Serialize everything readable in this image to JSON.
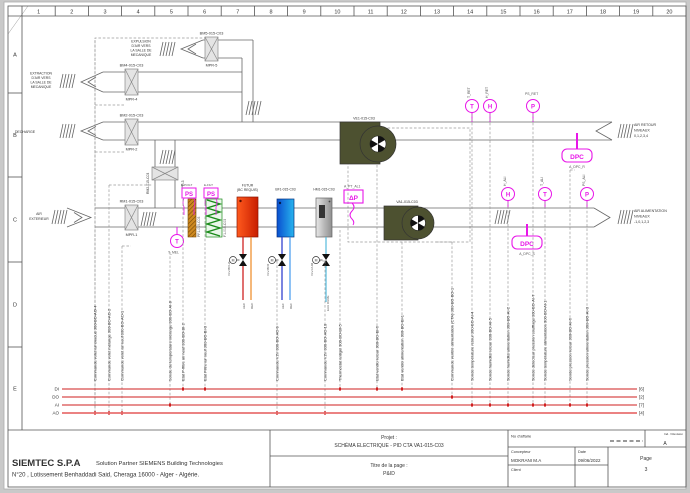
{
  "sheet": {
    "columns": [
      "1",
      "2",
      "3",
      "4",
      "5",
      "6",
      "7",
      "8",
      "9",
      "10",
      "11",
      "12",
      "13",
      "14",
      "15",
      "16",
      "17",
      "18",
      "19",
      "20"
    ],
    "rows": [
      "A",
      "B",
      "C",
      "D",
      "E"
    ]
  },
  "labels": {
    "expulsion": [
      "EXPULSION",
      "D'AIR VERS",
      "LA SALLE DE",
      "MECANIQUE"
    ],
    "extraction": [
      "EXTRACTION",
      "D'AIR VERS",
      "LA SALLE DE",
      "MECANIQUE"
    ],
    "decharge": "DECHARGE",
    "air_exterieur": [
      "AIR",
      "EXTERIEUR"
    ],
    "air_retour": [
      "AIR RETOUR",
      "NIVEAUX",
      "0,1,2,3,4"
    ],
    "air_alimentation": [
      "AIR ALIMENTATION",
      "NIVEAUX",
      "-1,0,1,2,3"
    ]
  },
  "dampers": [
    {
      "tag": "BM5-015-C03",
      "motor": "MPR-5"
    },
    {
      "tag": "BM4-015-C03",
      "motor": "MPR-4"
    },
    {
      "tag": "BM2-015-C03",
      "motor": "MPR-2"
    },
    {
      "tag": "RM2-015-C03",
      "motor": "MPR-3"
    },
    {
      "tag": "RM1-015-C03",
      "motor": "MPR-1"
    }
  ],
  "filters": {
    "ps": "PS",
    "prefilter_switch": "E-P.FILT",
    "filter_switch": "E-FILT",
    "prefilter_tag": "PF1-015-C03",
    "filter_tag": "F1-015-C03"
  },
  "coils": {
    "hot_line1": "FUTUR",
    "hot_line2": "(BC REQUIS)",
    "cold": "BF1-015-C03",
    "humidifier": "HM1-015-C03"
  },
  "fans": {
    "extract": "VE1-015-C03",
    "supply": "VA1-015-C03"
  },
  "sensors": {
    "letters": {
      "t": "T",
      "h": "H",
      "p": "P",
      "m": "M"
    },
    "dp": "ΔP",
    "dp_tag": "A_PT_AL1",
    "t_mel": "T_MEL",
    "t_ret": "T_RET",
    "h_ret": "H_RET",
    "ps_ret": "PS_RET",
    "h_ali": "H_ALI",
    "t_ali": "T_ALI",
    "ps_ali": "PS_ALI",
    "dpc": "DPC",
    "dpc_r": "A_DPC_R",
    "dpc_s": "A_DPC_S"
  },
  "valves": {
    "hot": "VLV-BCHA",
    "cold": "VLV-BFR",
    "hum": "VLV-HUM",
    "pipes": {
      "aec": "AEC",
      "rec": "REC",
      "aef": "AEF",
      "ref": "REF",
      "eau": "EAU DURE"
    }
  },
  "io_points": [
    "Commande volet air évacué 300-BO-AO-4",
    "Commande volet mélange 300-BO-AO-2",
    "Commande volet air neuf 300-BO-AO-1",
    "Sonde de température mélange 300-BO-AI-8",
    "Etat P-filtre air neuf 300-BO-BI-2",
    "Etat Filtre air neuf 300-BO-BI-3",
    "Commande V2V 300-BO-AO-9",
    "Commande V2V 300-BO-AO-10",
    "Thermostat antigel 300-BO-BI-5",
    "Etat ventilo retour 300-BO-BI-6",
    "Etat ventilo alimentation 300-BO-BI-1",
    "Commande ventilo alimentation (CTA) 300-BO-BO-1",
    "Sonde température retour 300-BO-AI-4",
    "Sonde humidité retour 300-BO-AI-5",
    "Sonde humidité alimentation 300-BO-AI-2",
    "Sonde détecteur pression soufflage 300-BO-AI-7",
    "Sonde température alimentation 300-BO-AI-1",
    "Sonde pression retour 300-BO-AI-6",
    "Sonde pression alimentation 300-BO-AI-3"
  ],
  "bus": {
    "labels": [
      "DI",
      "DO",
      "AI",
      "AO"
    ],
    "ends": [
      "[6]",
      "[2]",
      "[7]",
      "[4]"
    ]
  },
  "title_block": {
    "company": "SIEMTEC  S.P.A",
    "partner": "Solution Partner SIEMENS Building Technologies",
    "address": "N°20 , Lotissement Benhaddadi Said, Cheraga 16000 - Alger - Algérie.",
    "project_label": "Projet :",
    "project": "SCHÉMA ELECTRIQUE  - PID CTA VA1-015-C03",
    "page_title_label": "Titre de la page :",
    "page_title": "P&ID",
    "affaire_label": "No d'affaire",
    "revision_label": "Ind. / Revision",
    "revision": "A",
    "designer_label": "Concepteur",
    "designer": "MOKRANI M.A",
    "date_label": "Date",
    "date": "09/06/2022",
    "client_label": "Client",
    "page_label": "Page",
    "page_number": "3"
  }
}
